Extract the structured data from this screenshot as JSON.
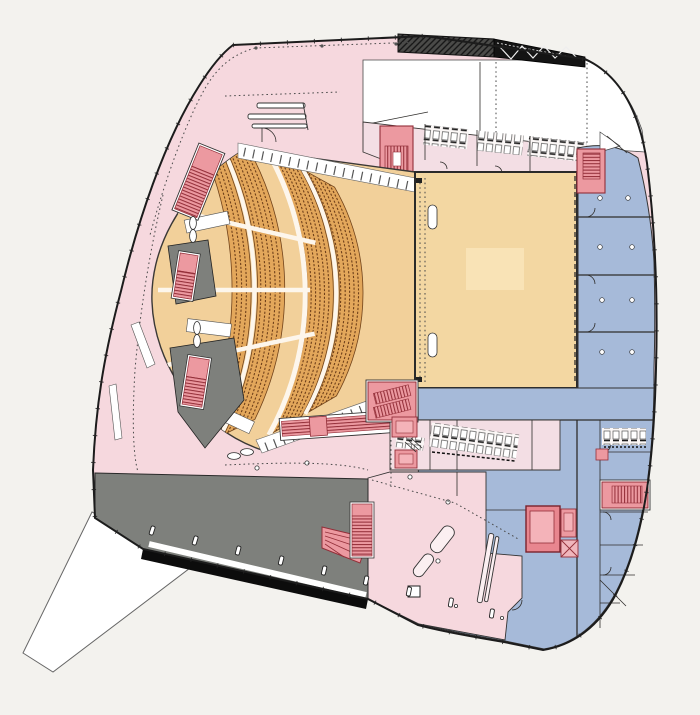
{
  "figure": {
    "kind": "architectural-floor-plan",
    "subject": "auditorium level plan: fan-shaped seating, stage platform, foyers, back-of-house wing, terrace",
    "visible_text_labels": []
  },
  "palette": {
    "background": "#f3f2ee",
    "foyer": "#f6d8de",
    "paleRooms": "#f3dee4",
    "seatingBank": "#e3a75b",
    "parterre": "#f2d09a",
    "stage": "#f3d7a2",
    "stageInset": "#f9e3b6",
    "blue": "#a6bad9",
    "terrace": "#7e807c",
    "stairRed": "#ec99a0",
    "stairRedDark": "#932f39",
    "truss": "#141414",
    "trussHatch": "#4a4a48",
    "wallInk": "#2f2d2b",
    "white": "#ffffff",
    "bandBlack": "#0c0c0c"
  },
  "zones": [
    {
      "id": "public-foyer",
      "color": "#f6d8de",
      "role": "public foyer and circulation (pink)"
    },
    {
      "id": "auditorium-seating",
      "color": "#e3a75b",
      "role": "curved seating banks (tan)"
    },
    {
      "id": "parterre-open-floor",
      "color": "#f2d09a",
      "role": "open auditorium floor"
    },
    {
      "id": "stage-platform",
      "color": "#f3d7a2",
      "role": "stage / platform"
    },
    {
      "id": "back-of-house",
      "color": "#a6bad9",
      "role": "dressing and service rooms (blue)"
    },
    {
      "id": "service-pale-rooms",
      "color": "#f3dee4",
      "role": "toilets / ancillary rooms (pale pink)"
    },
    {
      "id": "stair-cores",
      "color": "#ec99a0",
      "role": "stairs and vertical cores (red)"
    },
    {
      "id": "terrace-deck",
      "color": "#7e807c",
      "role": "outdoor terrace deck (dark gray)"
    },
    {
      "id": "roof-truss",
      "color": "#141414",
      "role": "roof truss / bridge element (black)"
    },
    {
      "id": "exterior-ramp",
      "color": "#ffffff",
      "role": "external ramp wedge"
    }
  ],
  "auditorium": {
    "seat_banks": 4,
    "row_arcs_per_bank": [
      5,
      5,
      5,
      3
    ],
    "radial_aisles": 3,
    "vomitory_entries": 3,
    "door_leaf_pairs": 3
  },
  "counts": {
    "stair_elements": 14,
    "facade_posts": 9,
    "blue_wing_partitions": 3,
    "right_rooms_partitions": 5
  }
}
